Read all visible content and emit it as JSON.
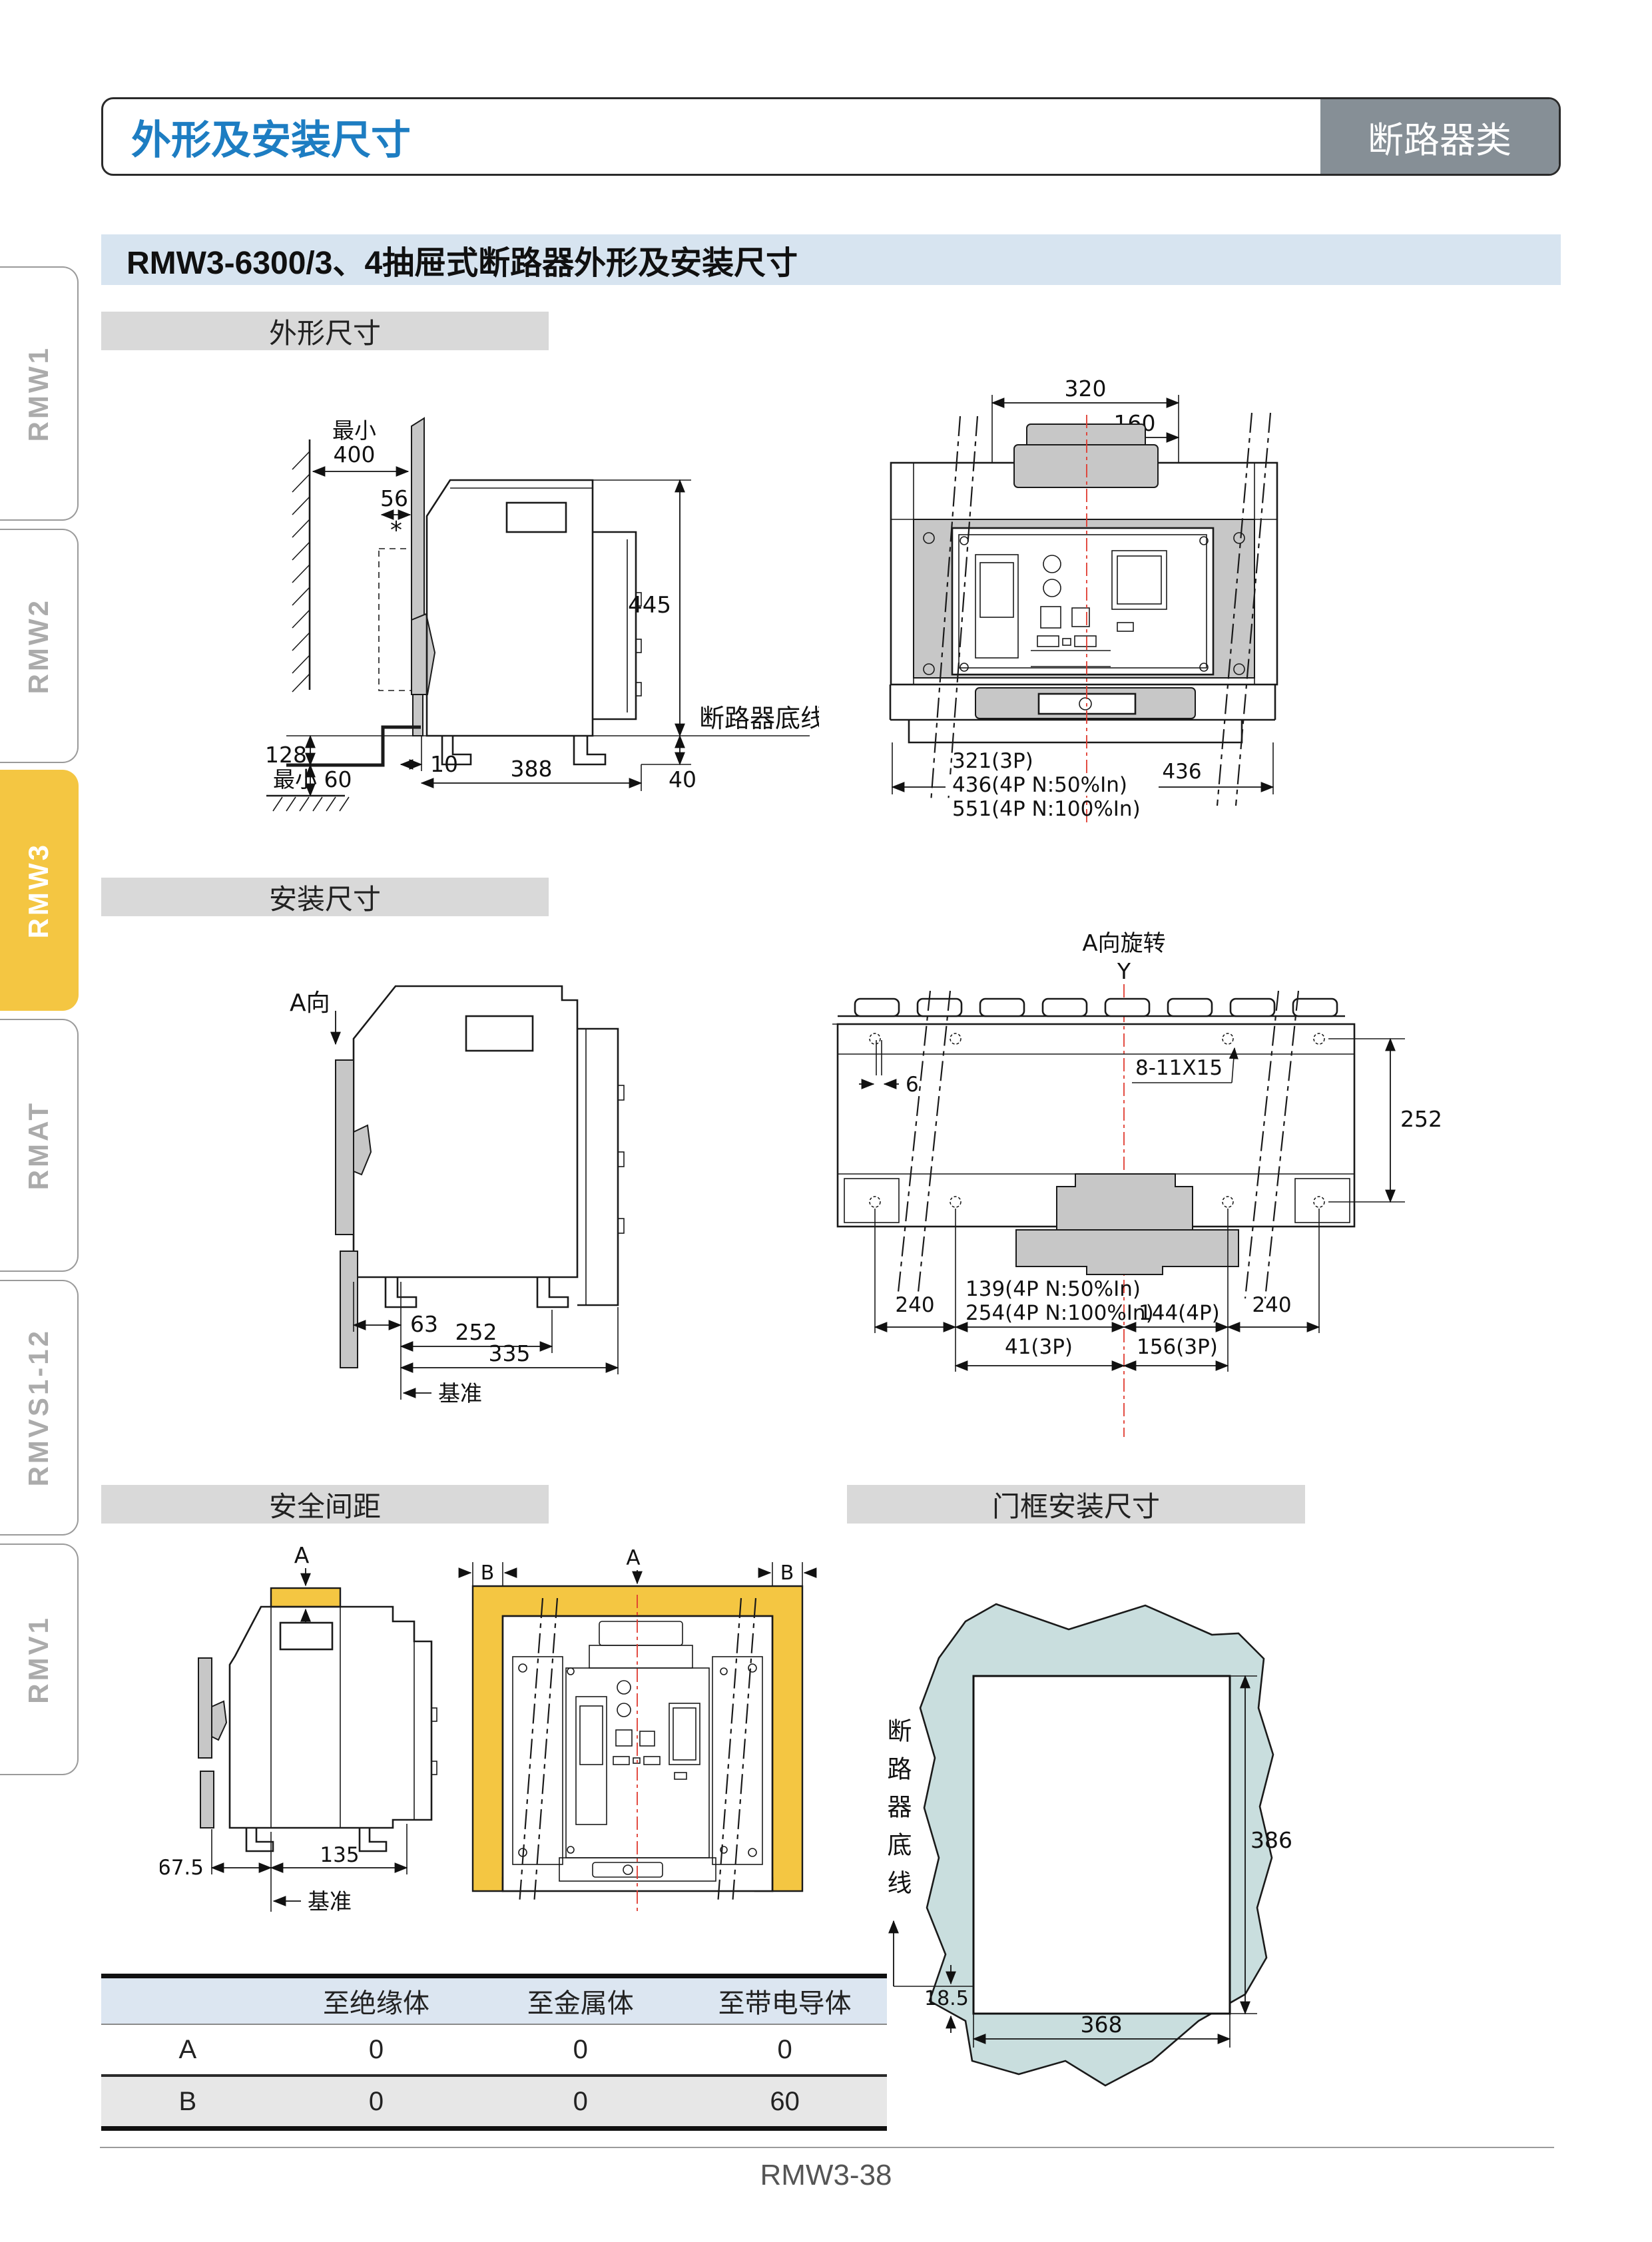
{
  "header": {
    "title": "外形及安装尺寸",
    "badge": "断路器类"
  },
  "section": {
    "title": "RMW3-6300/3、4抽屉式断路器外形及安装尺寸"
  },
  "sidebar": {
    "items": [
      {
        "label": "RMW1",
        "active": false
      },
      {
        "label": "RMW2",
        "active": false
      },
      {
        "label": "RMW3",
        "active": true
      },
      {
        "label": "RMAT",
        "active": false
      },
      {
        "label": "RMVS1-12",
        "active": false
      },
      {
        "label": "RMV1",
        "active": false
      }
    ]
  },
  "subsections": {
    "outline": "外形尺寸",
    "install": "安装尺寸",
    "safety": "安全间距",
    "doorframe": "门框安装尺寸"
  },
  "colors": {
    "accent_blue": "#1d7dc2",
    "badge_bg": "#868f96",
    "section_bg": "#d7e4f0",
    "bar_bg": "#d9d9d9",
    "active_tab_yellow": "#f4c642",
    "safety_yellow": "#f4c642",
    "door_teal": "#c9dede",
    "centerline_red": "#e03a2f"
  },
  "outline_side": {
    "min_label": "最小",
    "d400": "400",
    "d56": "56",
    "star": "*",
    "d445": "445",
    "baseline_label": "断路器底线",
    "d128": "128",
    "min60": "最小 60",
    "d10": "10",
    "d388": "388",
    "d40": "40"
  },
  "outline_front": {
    "d320": "320",
    "y_label": "Y",
    "d160": "160",
    "w3p": "321(3P)",
    "w4p50": "436(4P N:50%In)",
    "w4p100": "551(4P N:100%In)",
    "d436": "436"
  },
  "install_side": {
    "a_label": "A向",
    "d63": "63",
    "d252": "252",
    "d335": "335",
    "datum_label": "基准"
  },
  "install_top": {
    "a_label": "A向旋转",
    "y_label": "Y",
    "d6": "6",
    "hole_label": "8-11X15",
    "d252": "252",
    "d240_left": "240",
    "n4p50": "139(4P N:50%In)",
    "n4p100": "254(4P N:100%In)",
    "d144": "144(4P)",
    "d240_right": "240",
    "d41": "41(3P)",
    "d156": "156(3P)"
  },
  "safety_side": {
    "a_label": "A",
    "d675": "67.5",
    "d135": "135",
    "datum_label": "基准"
  },
  "safety_front": {
    "a_label": "A",
    "b_left": "B",
    "b_right": "B"
  },
  "doorframe": {
    "baseline_label": "断路器底线",
    "d386": "386",
    "d368": "368",
    "d185": "18.5"
  },
  "table": {
    "headers": [
      "",
      "至绝缘体",
      "至金属体",
      "至带电导体"
    ],
    "rows": [
      {
        "label": "A",
        "values": [
          "0",
          "0",
          "0"
        ]
      },
      {
        "label": "B",
        "values": [
          "0",
          "0",
          "60"
        ]
      }
    ]
  },
  "footer": {
    "page_number": "RMW3-38"
  }
}
